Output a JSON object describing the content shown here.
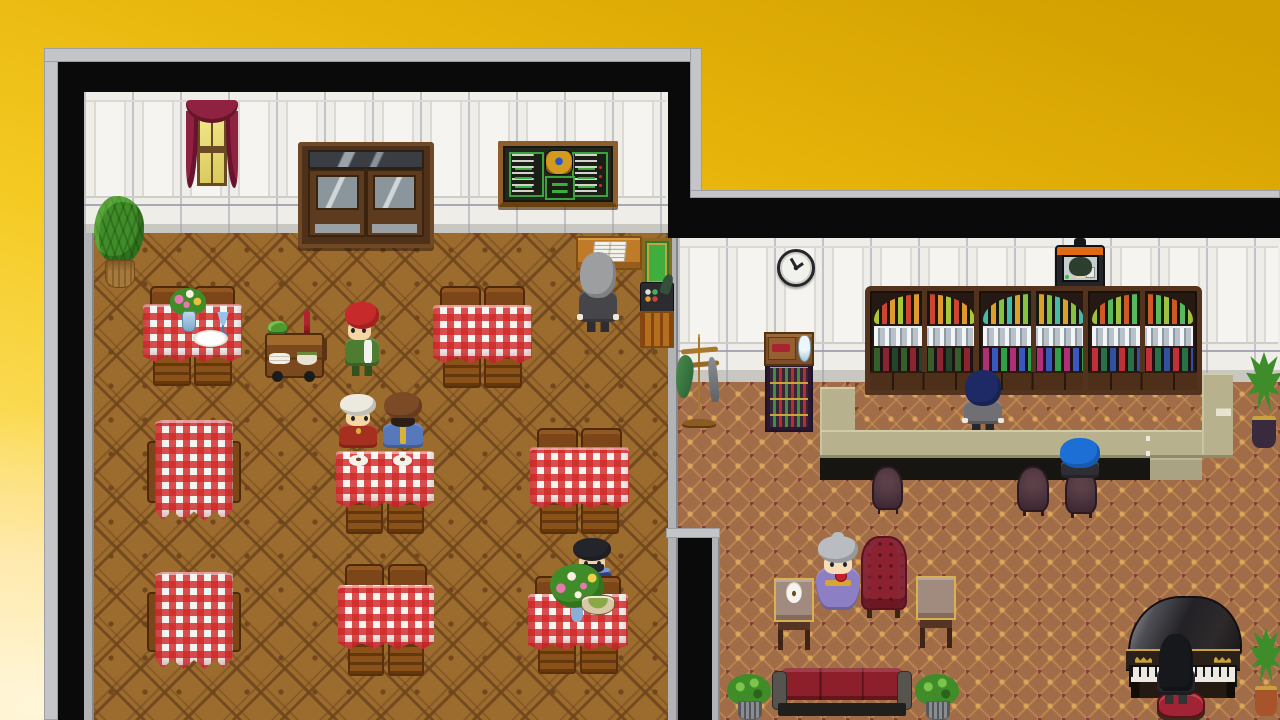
{
  "scene": {
    "label": "RPG tavern map: restaurant room and bar lounge room on golden gradient background",
    "palette": {
      "sky_deep": "#d2a000",
      "sky_gold": "#e6b30a",
      "sky_mid": "#f4ca22",
      "sky_light": "#fbdb55",
      "sky_pale": "#ffeaa4",
      "cloud": "#fff6da",
      "frame_black": "#0a0a0a",
      "frame_gray": "#c4c5c9",
      "trim_gray": "#b2b3b7",
      "wall": "#efede8",
      "baseboard": "#c9c7c2",
      "carpet_rest": "#9c6b2e",
      "carpet_lounge": "#a06d48",
      "bar_top": "#b7b18d",
      "bar_top_dark": "#a9a384",
      "bar_face": "#171512",
      "cloth": "#f5f5f2",
      "gingham_red": "#d12a2a",
      "wood": "#7c4618",
      "wood_dark": "#4e2a0a",
      "wood_mid": "#8a5118",
      "gold": "#c9a23f",
      "green_board": "#3aa33a",
      "sofa": "#8c1f2a",
      "armchair": "#8c2130",
      "chair_plum": "#4a323c"
    },
    "rooms": {
      "restaurant": {
        "name": "restaurant-room"
      },
      "lounge": {
        "name": "bar-lounge-room"
      }
    },
    "sprites": [
      {
        "id": "potted-plant-restaurant",
        "type": "plantb",
        "x": 94,
        "y": 196,
        "w": 50,
        "h": 92,
        "interactable": false
      },
      {
        "id": "curtained-window",
        "type": "window",
        "x": 186,
        "y": 100,
        "w": 52,
        "h": 94,
        "interactable": false,
        "classes": [],
        "colors": {}
      },
      {
        "id": "double-door",
        "type": "door",
        "x": 298,
        "y": 142,
        "w": 128,
        "h": 98,
        "interactable": true
      },
      {
        "id": "menu-chalkboard",
        "type": "menu",
        "x": 498,
        "y": 141,
        "w": 110,
        "h": 56,
        "interactable": true
      },
      {
        "id": "reception-book-desk",
        "type": "bookdesk",
        "x": 576,
        "y": 236,
        "w": 62,
        "h": 30,
        "interactable": true
      },
      {
        "id": "cash-register-stand",
        "type": "register",
        "x": 640,
        "y": 238,
        "w": 34,
        "h": 110,
        "interactable": true
      },
      {
        "id": "host-npc",
        "type": "char",
        "x": 578,
        "y": 252,
        "w": 40,
        "h": 80,
        "interactable": true,
        "classes": [
          "char--away",
          "char--cuffs"
        ],
        "colors": {
          "hair": "#9c9ea0",
          "skin": "#f2d4a6",
          "outfit": "#46464a",
          "pants": "#2e2e32"
        }
      },
      {
        "id": "table-top-left",
        "type": "tableH",
        "x": 143,
        "y": 286,
        "w": 99,
        "h": 96,
        "interactable": false
      },
      {
        "id": "flower-vase",
        "type": "vase",
        "x": 170,
        "y": 288,
        "w": 36,
        "h": 44,
        "z": 392,
        "interactable": false
      },
      {
        "id": "blue-goblet",
        "type": "goblet",
        "x": 216,
        "y": 312,
        "w": 14,
        "h": 24,
        "z": 392,
        "interactable": false
      },
      {
        "id": "dinner-plate",
        "type": "plate",
        "x": 193,
        "y": 330,
        "w": 35,
        "h": 17,
        "z": 392,
        "interactable": false
      },
      {
        "id": "serving-cart",
        "type": "cart",
        "x": 262,
        "y": 310,
        "w": 70,
        "h": 76,
        "interactable": false
      },
      {
        "id": "waitress-npc",
        "type": "char",
        "x": 344,
        "y": 302,
        "w": 36,
        "h": 74,
        "interactable": true,
        "classes": [
          "char--left"
        ],
        "colors": {
          "hair": "#c62a2a",
          "skin": "#f6d7a4",
          "outfit": "#4e7c30",
          "accent": "#f2f2ee",
          "pants": "#31511d"
        }
      },
      {
        "id": "table-top-middle",
        "type": "tableH",
        "x": 433,
        "y": 286,
        "w": 99,
        "h": 98,
        "interactable": false
      },
      {
        "id": "table-mid-left",
        "type": "tableV",
        "x": 147,
        "y": 420,
        "w": 94,
        "h": 104,
        "interactable": false
      },
      {
        "id": "diner-elder-npc",
        "type": "char",
        "x": 338,
        "y": 394,
        "w": 40,
        "h": 62,
        "interactable": true,
        "classes": [
          "char--seated",
          "char--dot"
        ],
        "colors": {
          "hair": "#eceadf",
          "skin": "#f6d7a4",
          "outfit": "#a63020",
          "accent": "#d8b23a"
        }
      },
      {
        "id": "diner-monk-npc",
        "type": "char",
        "x": 382,
        "y": 392,
        "w": 42,
        "h": 64,
        "interactable": true,
        "classes": [
          "char--seated",
          "char--bald",
          "char--vline"
        ],
        "colors": {
          "hair": "#7c4a26",
          "skin": "#7c4a26",
          "beard": "#2a1e16",
          "outfit": "#5878bc",
          "accent": "#d8b23a"
        }
      },
      {
        "id": "diners-table",
        "type": "tableP",
        "x": 336,
        "y": 446,
        "w": 98,
        "h": 86,
        "interactable": false
      },
      {
        "id": "table-mid-right",
        "type": "tableH",
        "x": 530,
        "y": 428,
        "w": 99,
        "h": 102,
        "interactable": false
      },
      {
        "id": "table-bottom-left",
        "type": "tableV",
        "x": 147,
        "y": 572,
        "w": 94,
        "h": 100,
        "interactable": false
      },
      {
        "id": "table-bottom-middle",
        "type": "tableH",
        "x": 338,
        "y": 564,
        "w": 96,
        "h": 108,
        "interactable": false
      },
      {
        "id": "bearded-diner-npc",
        "type": "char",
        "x": 571,
        "y": 538,
        "w": 42,
        "h": 64,
        "interactable": true,
        "classes": [
          "char--seated",
          "char--shoulders"
        ],
        "colors": {
          "hair": "#23252a",
          "skin": "#f0d4a8",
          "beard": "#23252a",
          "outfit": "#2e3e7e",
          "accent": "#7a9ad0"
        }
      },
      {
        "id": "table-bottom-right",
        "type": "tableH",
        "x": 528,
        "y": 576,
        "w": 100,
        "h": 94,
        "interactable": false
      },
      {
        "id": "flower-bouquet",
        "type": "bouquet",
        "x": 550,
        "y": 564,
        "w": 54,
        "h": 58,
        "z": 676,
        "interactable": false
      },
      {
        "id": "soup-bowl",
        "type": "bowlp",
        "x": 581,
        "y": 595,
        "w": 32,
        "h": 18,
        "z": 677,
        "interactable": false
      },
      {
        "id": "wall-clock",
        "type": "clock",
        "x": 777,
        "y": 249,
        "w": 32,
        "h": 32,
        "interactable": false
      },
      {
        "id": "tv-portrait",
        "type": "tv",
        "x": 1055,
        "y": 238,
        "w": 50,
        "h": 52,
        "interactable": false
      },
      {
        "id": "coat-rack",
        "type": "coatrack",
        "x": 676,
        "y": 334,
        "w": 46,
        "h": 94,
        "interactable": false
      },
      {
        "id": "wine-display-stand",
        "type": "winestand",
        "x": 764,
        "y": 332,
        "w": 50,
        "h": 100,
        "interactable": false
      },
      {
        "id": "wine-cabinet-1",
        "type": "winecab",
        "x": 865,
        "y": 286,
        "w": 109,
        "h": 99,
        "interactable": false,
        "colors": {
          "ba": "#a8c838",
          "bb": "#cc4433",
          "bc": "#e09830",
          "bd": "#355e2a",
          "be": "#8a2430",
          "bf": "#24442a"
        }
      },
      {
        "id": "wine-cabinet-2",
        "type": "winecab",
        "x": 974,
        "y": 286,
        "w": 109,
        "h": 99,
        "interactable": false,
        "colors": {
          "ba": "#48b8a8",
          "bb": "#e0a028",
          "bc": "#88c040",
          "bd": "#b03078",
          "be": "#3858c0",
          "bf": "#30a048"
        }
      },
      {
        "id": "wine-cabinet-3",
        "type": "winecab",
        "x": 1083,
        "y": 286,
        "w": 109,
        "h": 99,
        "interactable": false,
        "colors": {
          "ba": "#a0c040",
          "bb": "#d05828",
          "bc": "#58b860",
          "bd": "#c03038",
          "be": "#287048",
          "bf": "#3050a0"
        }
      },
      {
        "id": "bartender-npc",
        "type": "char",
        "x": 963,
        "y": 370,
        "w": 40,
        "h": 62,
        "z": 430,
        "interactable": true,
        "classes": [
          "char--away",
          "char--cuffs"
        ],
        "colors": {
          "hair": "#1e2a66",
          "skin": "#f2d4a6",
          "outfit": "#707074",
          "pants": "#26262c"
        }
      },
      {
        "id": "bar-bottle",
        "type": "bottle",
        "x": 1216,
        "y": 388,
        "w": 15,
        "h": 39,
        "z": 472,
        "interactable": false
      },
      {
        "id": "plant-bar-end",
        "type": "plantt",
        "x": 1246,
        "y": 352,
        "w": 36,
        "h": 96,
        "interactable": false,
        "colors": {
          "pot": "#3a2a3e"
        }
      },
      {
        "id": "bar-chair-1",
        "type": "barchair",
        "x": 869,
        "y": 466,
        "w": 37,
        "h": 50,
        "interactable": true
      },
      {
        "id": "bar-chair-2",
        "type": "barchair",
        "x": 1014,
        "y": 466,
        "w": 38,
        "h": 52,
        "interactable": true
      },
      {
        "id": "bar-chair-3",
        "type": "barchair",
        "x": 1062,
        "y": 468,
        "w": 38,
        "h": 52,
        "interactable": true
      },
      {
        "id": "bar-patron-npc",
        "type": "char",
        "x": 1060,
        "y": 438,
        "w": 40,
        "h": 46,
        "z": 526,
        "interactable": true,
        "classes": [
          "char--away",
          "char--seated",
          "char--bighair"
        ],
        "colors": {
          "hair": "#1d6fd6",
          "skin": "#f2d4a6",
          "outfit": "#2e2e34"
        }
      },
      {
        "id": "side-table-with-coffee",
        "type": "sidetable",
        "x": 774,
        "y": 578,
        "w": 40,
        "h": 72,
        "interactable": false,
        "classes": [
          "has-cup"
        ]
      },
      {
        "id": "grandma-npc",
        "type": "char",
        "x": 816,
        "y": 536,
        "w": 44,
        "h": 74,
        "interactable": true,
        "classes": [
          "char--lady"
        ],
        "colors": {
          "hair": "#b9bcc0",
          "skin": "#f6ddb8",
          "outfit": "#8d7fc4",
          "accent": "#d8a437"
        }
      },
      {
        "id": "lounge-armchair",
        "type": "armchair",
        "x": 859,
        "y": 536,
        "w": 50,
        "h": 82,
        "interactable": false
      },
      {
        "id": "side-table-right",
        "type": "sidetable",
        "x": 916,
        "y": 576,
        "w": 40,
        "h": 72,
        "interactable": false
      },
      {
        "id": "lounge-sofa",
        "type": "sofa",
        "x": 772,
        "y": 668,
        "w": 140,
        "h": 52,
        "interactable": false
      },
      {
        "id": "plant-sofa-left",
        "type": "plants",
        "x": 727,
        "y": 674,
        "w": 44,
        "h": 46,
        "interactable": false
      },
      {
        "id": "plant-sofa-right",
        "type": "plants",
        "x": 915,
        "y": 674,
        "w": 44,
        "h": 46,
        "interactable": false
      },
      {
        "id": "grand-piano",
        "type": "piano",
        "x": 1126,
        "y": 596,
        "w": 114,
        "h": 102,
        "interactable": true
      },
      {
        "id": "piano-stool",
        "type": "stool",
        "x": 1157,
        "y": 690,
        "w": 44,
        "h": 24,
        "z": 700,
        "interactable": false
      },
      {
        "id": "pianist-npc",
        "type": "char",
        "x": 1156,
        "y": 634,
        "w": 40,
        "h": 70,
        "z": 706,
        "interactable": true,
        "classes": [
          "char--away",
          "char--longhair"
        ],
        "colors": {
          "hair": "#17181c",
          "skin": "#f2d4a6",
          "outfit": "#26262a"
        }
      },
      {
        "id": "plant-piano-corner",
        "type": "plantt",
        "x": 1250,
        "y": 628,
        "w": 32,
        "h": 88,
        "interactable": false,
        "colors": {
          "pot": "#a8542a"
        }
      }
    ]
  }
}
